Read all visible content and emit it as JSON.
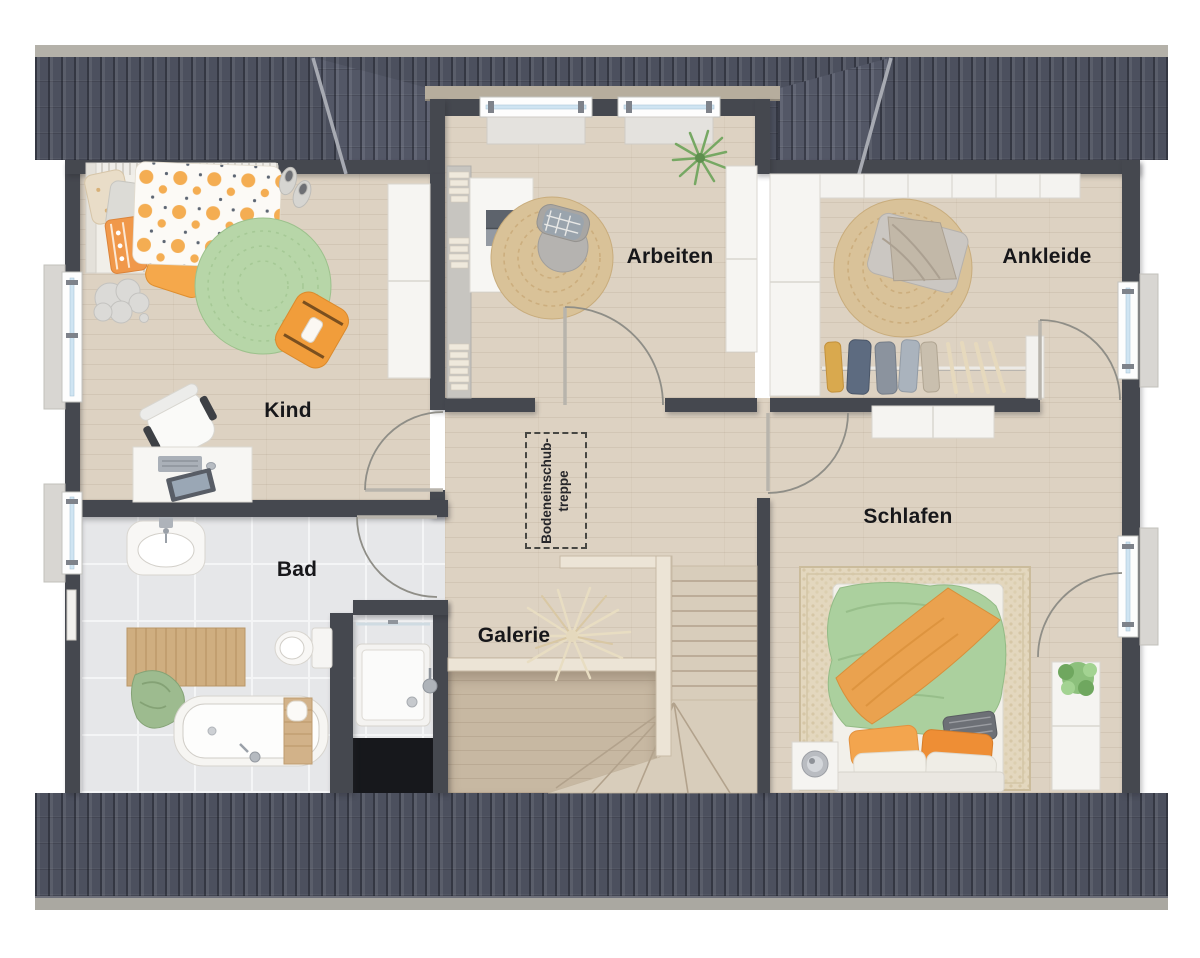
{
  "plan": {
    "type": "floor-plan-top-view",
    "rooms": {
      "kind": {
        "label": "Kind"
      },
      "arbeiten": {
        "label": "Arbeiten"
      },
      "ankleide": {
        "label": "Ankleide"
      },
      "schlafen": {
        "label": "Schlafen"
      },
      "bad": {
        "label": "Bad"
      },
      "galerie": {
        "label": "Galerie"
      }
    },
    "annotations": {
      "attic_hatch_line1": "Bodeneinschub-",
      "attic_hatch_line2": "treppe"
    }
  },
  "colors": {
    "roof": "#4c505e",
    "wall": "#45484f",
    "wood_floor": "#ddd2c2",
    "lower_floor": "#c7b8a2",
    "tile_floor": "#e6e7e9",
    "accent_orange": "#f2a444",
    "accent_green": "#abd09e",
    "jute": "#d9c299",
    "window_glass": "#cfe4f2"
  }
}
